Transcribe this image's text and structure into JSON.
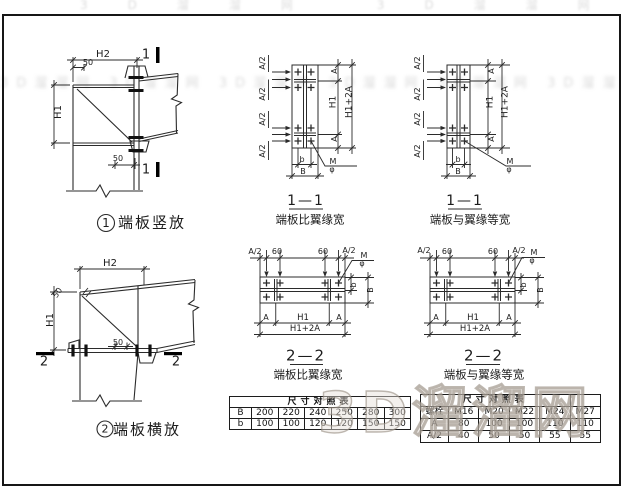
{
  "page": {
    "background": "#ffffff",
    "line_color": "#2b2b2b"
  },
  "watermark": {
    "band": "3D溜溜网 3D溜溜网 3D溜溜网 3D溜溜网 3D溜溜网 3D溜溜网",
    "top_band": "3D溜溜网 3D溜溜网",
    "big": "3D溜溜网"
  },
  "detail1": {
    "number": "1",
    "caption": "端板竖放",
    "section_mark": "1",
    "dim_h2": "H2",
    "dim_50_top": "50",
    "dim_h1": "H1",
    "dim_50_bottom": "50"
  },
  "detail2": {
    "number": "2",
    "caption": "端板横放",
    "section_mark": "2",
    "dim_h2": "H2",
    "dim_50_top": "50",
    "dim_h1": "H1",
    "dim_50_mid": "50"
  },
  "section_1_1_wide": {
    "title": "1—1",
    "subtitle": "端板比翼缘宽",
    "dim_a_half": "A/2",
    "dim_a": "A",
    "dim_h1": "H1",
    "dim_total": "H1+2A",
    "dim_b": "b",
    "dim_B": "B",
    "bolt_m": "M",
    "bolt_dia": "φ"
  },
  "section_1_1_equal": {
    "title": "1—1",
    "subtitle": "端板与翼缘等宽",
    "dim_a_half": "A/2",
    "dim_a": "A",
    "dim_h1": "H1",
    "dim_total": "H1+2A",
    "dim_b": "b",
    "dim_B": "B",
    "bolt_m": "M",
    "bolt_dia": "φ"
  },
  "section_2_2_wide": {
    "title": "2—2",
    "subtitle": "端板比翼缘宽",
    "dim_a_half": "A/2",
    "dim_60": "60",
    "dim_a": "A",
    "dim_h1": "H1",
    "dim_total": "H1+2A",
    "dim_b": "b",
    "dim_B": "B",
    "bolt_m": "M",
    "bolt_dia": "φ"
  },
  "section_2_2_equal": {
    "title": "2—2",
    "subtitle": "端板与翼缘等宽",
    "dim_a_half": "A/2",
    "dim_60": "60",
    "dim_a": "A",
    "dim_h1": "H1",
    "dim_total": "H1+2A",
    "dim_b": "b",
    "dim_B": "B",
    "bolt_m": "M",
    "bolt_dia": "φ"
  },
  "size_table": {
    "title": "尺寸对照表",
    "row_labels": [
      "B",
      "b"
    ],
    "rows": [
      [
        "200",
        "220",
        "240",
        "250",
        "280",
        "300"
      ],
      [
        "100",
        "100",
        "120",
        "120",
        "150",
        "150"
      ]
    ]
  },
  "bolt_table": {
    "title": "尺寸对照表",
    "row_labels": [
      "螺栓",
      "A",
      "A/2"
    ],
    "rows": [
      [
        "M16",
        "M20",
        "M22",
        "M24",
        "M27"
      ],
      [
        "80",
        "100",
        "100",
        "110",
        "110"
      ],
      [
        "40",
        "50",
        "50",
        "55",
        "55"
      ]
    ]
  }
}
